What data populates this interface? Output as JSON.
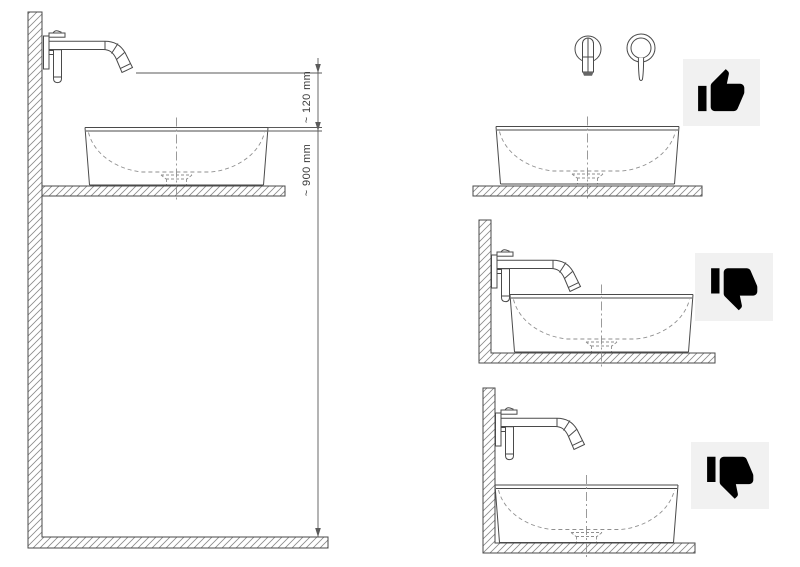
{
  "page": {
    "background": "#ffffff"
  },
  "diagram": {
    "dimension_labels": {
      "spout_clearance": "~ 120 mm",
      "rim_to_floor": "~ 900 mm"
    },
    "panels": {
      "main": {
        "view": "side view with installation dimensions",
        "icon": null
      },
      "top_right": {
        "view": "front view of spout and handle above basin",
        "icon": "thumbs-up-icon"
      },
      "middle_right": {
        "view": "side view, spout below basin rim",
        "icon": "thumbs-down-icon"
      },
      "bottom_right": {
        "view": "side view, basin pushed against wall",
        "icon": "thumbs-down-icon"
      }
    },
    "colors": {
      "line": "#4a4a4a",
      "light_line": "#8f8f8f",
      "icon_bg": "#f1f1f1",
      "icon_fill": "#000000",
      "background": "#ffffff"
    }
  }
}
